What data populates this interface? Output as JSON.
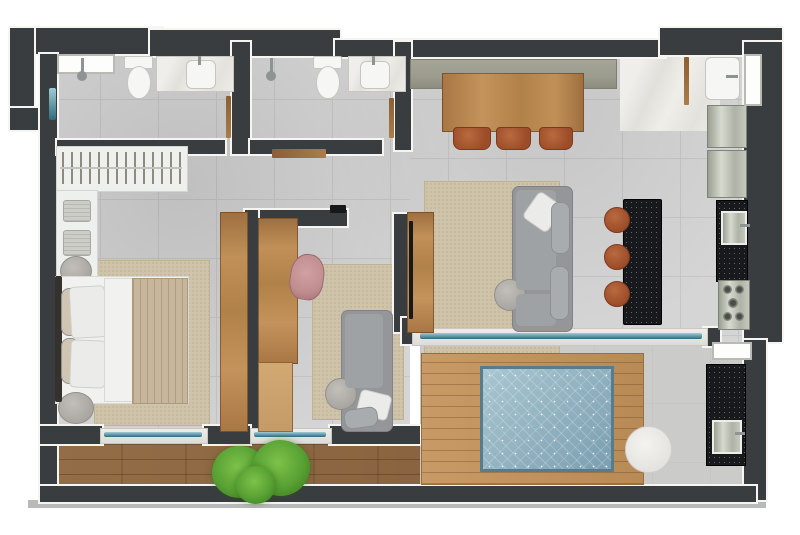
{
  "meta": {
    "type": "floor-plan",
    "description": "Top-down rendered apartment floor plan with two bathrooms, master bedroom, second room, open living-dining-kitchen, service area and wrap-around balcony with plunge pool",
    "visible_text": "none"
  },
  "palette": {
    "wall": "#3a3d40",
    "wall_edge": "#f6f5f2",
    "floor": "#d4d5d4",
    "floor_line": "#c5c6c5",
    "balcony_floor": "#cbccca",
    "marble": "#eceae6",
    "slab": "#b8bab9",
    "wood": "#b5854f",
    "deck": "#8f6a45",
    "platform": "#c0945f",
    "granite": "#17191c",
    "water": "#8fb3c2",
    "water_deep": "#7b9fb0",
    "rug": "#cfc3aa",
    "sofa": "#94969a",
    "sofa_light": "#a9acae",
    "pillow": "#ebebe9",
    "blanket": "#c7b69b",
    "terracotta": "#a2522f",
    "pink": "#c18e90",
    "olive": "#9c9c8e",
    "steel": "#c6c9c2",
    "white_fixture": "#f6f6f4",
    "glass": "#2f6b7c",
    "glass_light": "#9fcbd6",
    "plant": "#57a033",
    "plant_dark": "#3f7d22"
  },
  "rooms": [
    {
      "id": "bathroom-1",
      "area": "top-left",
      "fixtures": [
        "window-niche",
        "shower-head",
        "toilet",
        "marble-vanity",
        "sink",
        "swing-door"
      ]
    },
    {
      "id": "bathroom-2",
      "area": "top-center",
      "fixtures": [
        "shower-head",
        "toilet",
        "marble-vanity",
        "sink",
        "swing-door"
      ]
    },
    {
      "id": "hallway",
      "area": "center",
      "fixtures": [
        "wall-console-shelf"
      ]
    },
    {
      "id": "master-bedroom",
      "area": "left",
      "fixtures": [
        "open-closet-with-hangers",
        "closet-shelves-folded-clothes",
        "round-stool",
        "double-bed",
        "pillows",
        "blanket",
        "rug",
        "round-nightstand",
        "tall-wardrobe"
      ]
    },
    {
      "id": "second-room",
      "area": "center",
      "fixtures": [
        "built-in-wood-desk",
        "accent-chair",
        "rug",
        "daybed-sofa",
        "cushions",
        "round-side-table",
        "low-wood-shelf"
      ]
    },
    {
      "id": "living-dining",
      "area": "right",
      "fixtures": [
        "sideboard",
        "wood-dining-table",
        "dining-chairs",
        "area-rug",
        "tv-console",
        "tv",
        "chaise-sofa",
        "cushions",
        "round-coffee-table"
      ]
    },
    {
      "id": "kitchen",
      "area": "right-wall",
      "fixtures": [
        "granite-island",
        "bar-stools",
        "granite-counter",
        "counter-sink",
        "gas-cooktop"
      ]
    },
    {
      "id": "service-entry",
      "area": "top-right",
      "fixtures": [
        "laundry-sink",
        "washer",
        "refrigerator",
        "window",
        "entry-door",
        "marble-foyer"
      ]
    },
    {
      "id": "balcony",
      "area": "bottom",
      "fixtures": [
        "wood-deck",
        "potted-plant",
        "sliding-glass-doors",
        "pool-wood-platform",
        "plunge-pool",
        "round-white-table",
        "bbq-granite-counter",
        "bbq-sink",
        "window"
      ]
    }
  ],
  "counts": {
    "bathrooms": 2,
    "dining_chairs": 3,
    "bar_stools": 3,
    "sliding_glass_doors": 3,
    "plants": 1,
    "pools": 1
  }
}
